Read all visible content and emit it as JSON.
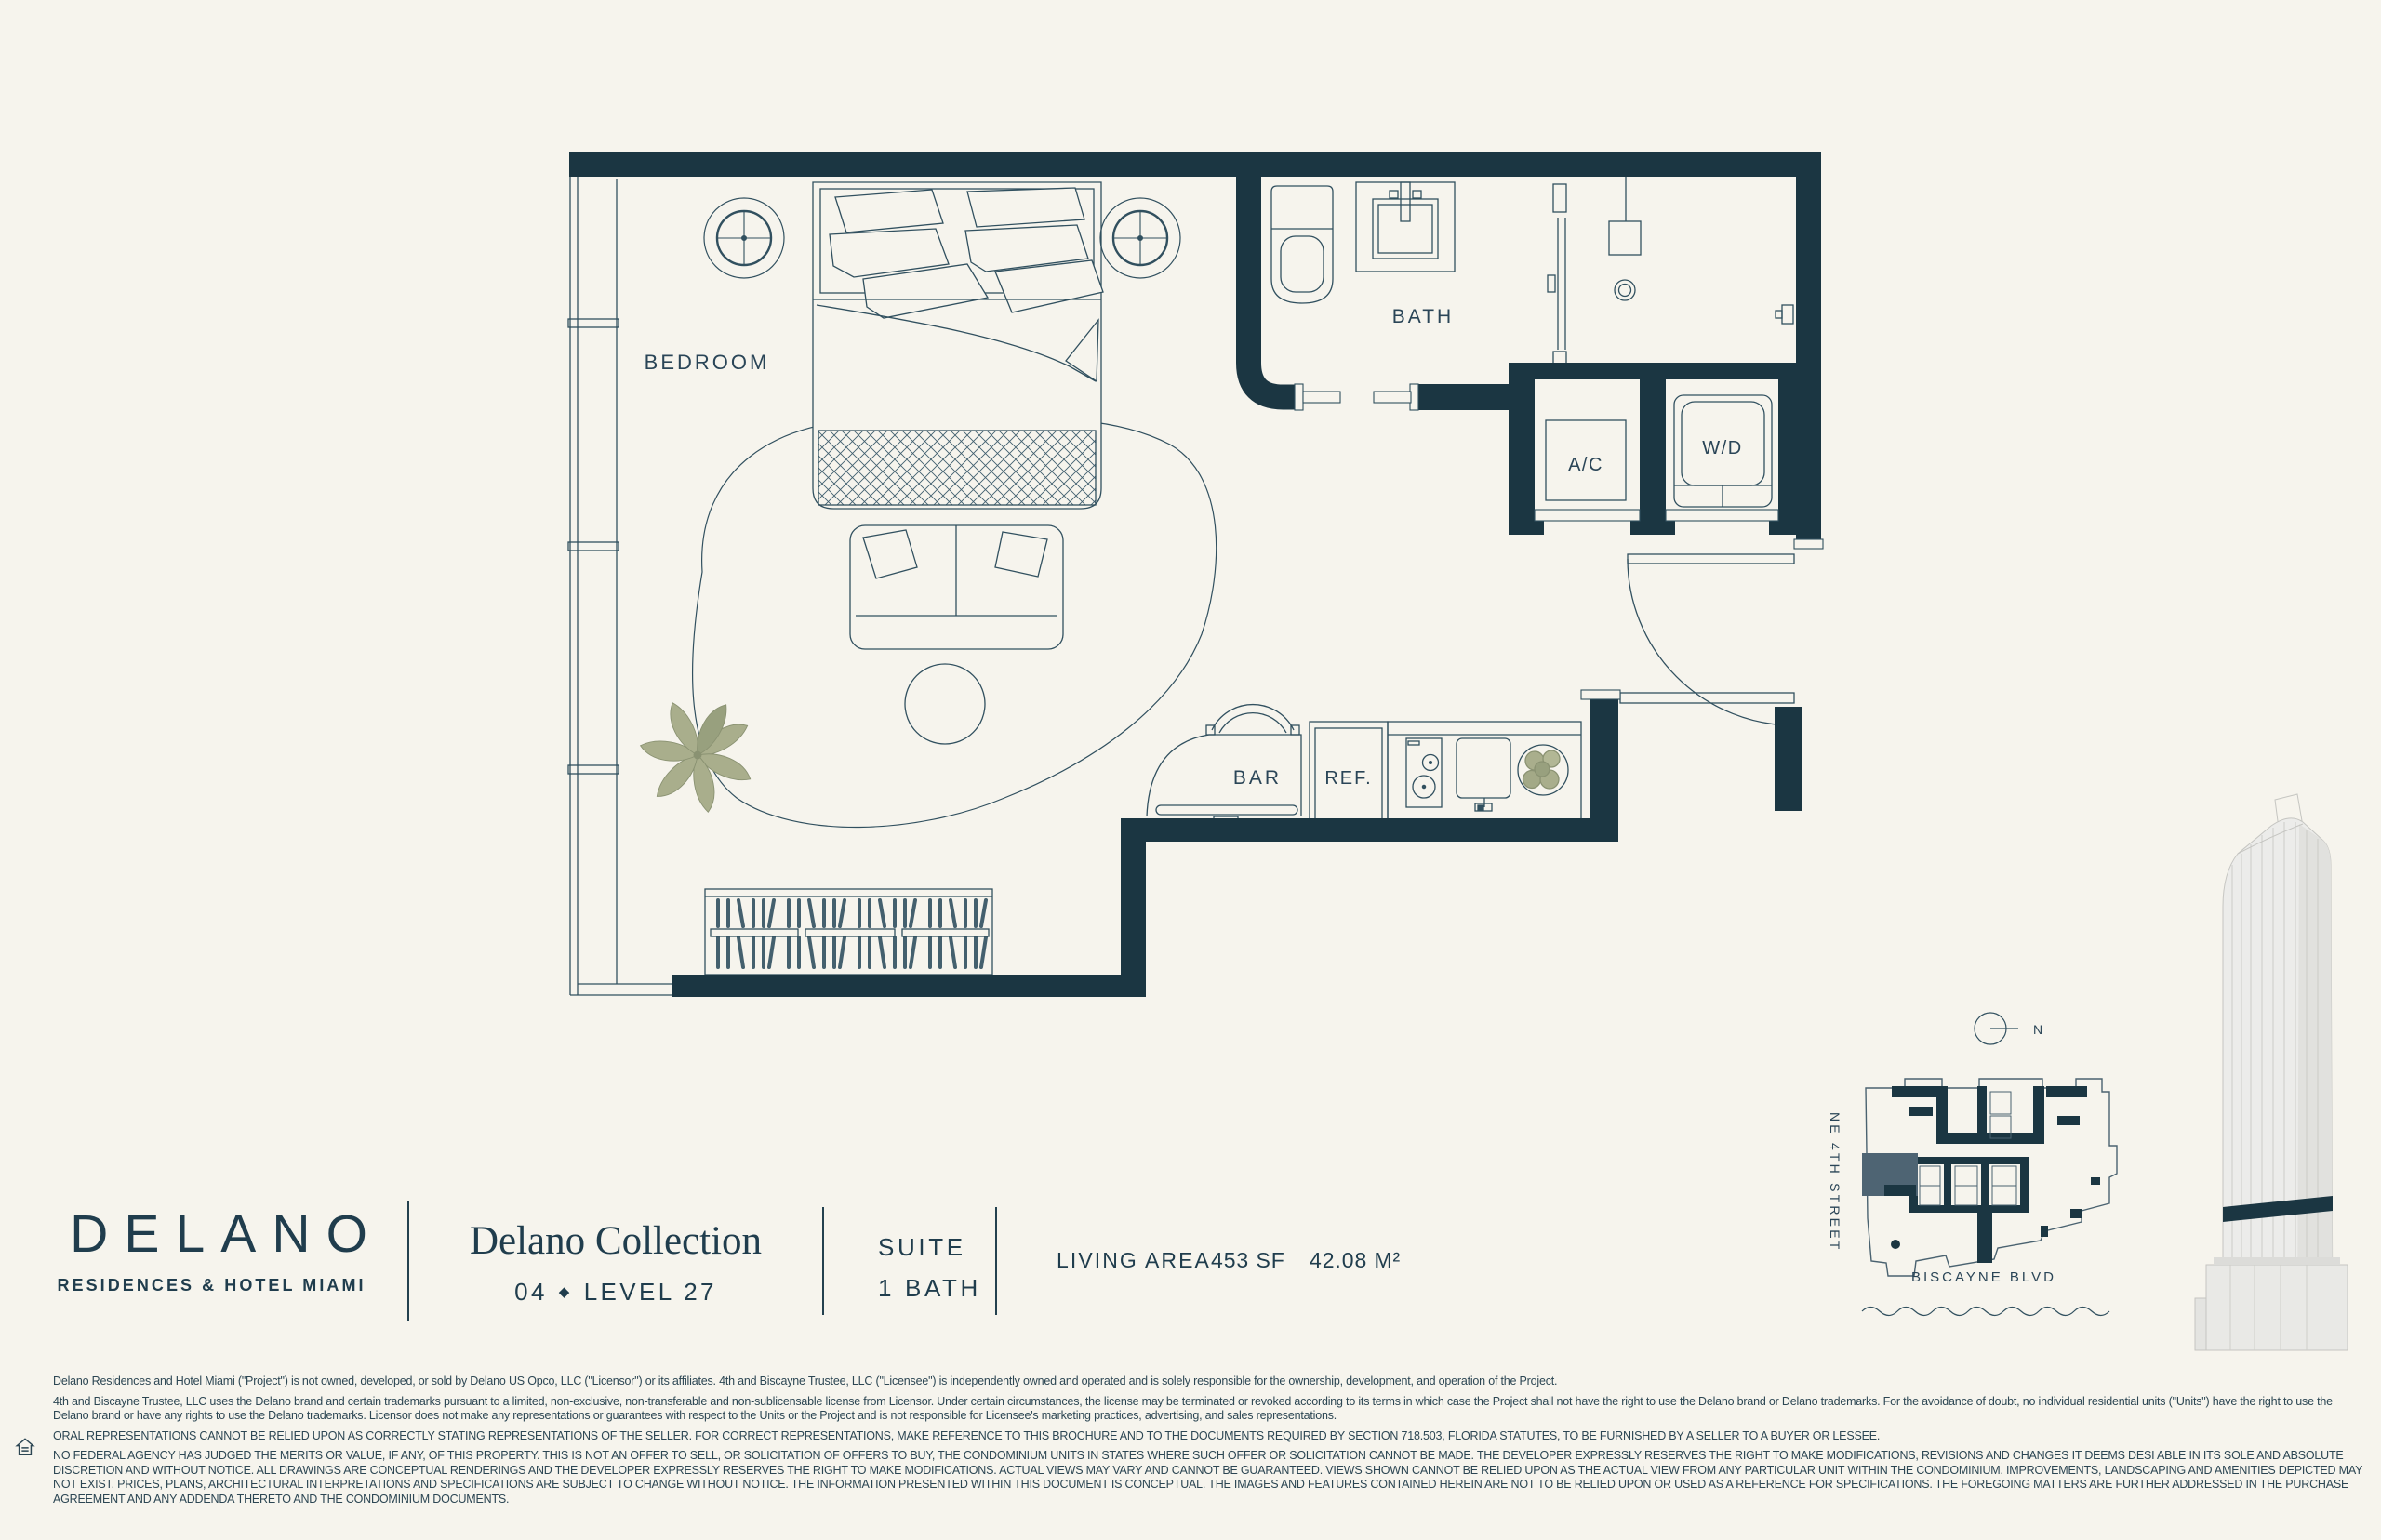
{
  "page": {
    "background_color": "#f6f4ed",
    "wall_color": "#1b3642",
    "line_color": "#31505f",
    "highlight_color": "#4e6473",
    "plant_green": "#a9ae8c"
  },
  "branding": {
    "logo": "DELANO",
    "tagline": "RESIDENCES & HOTEL MIAMI"
  },
  "plan_info": {
    "collection": "Delano Collection",
    "unit_number": "04",
    "separator": "◆",
    "level": "LEVEL 27",
    "suite": "SUITE",
    "baths": "1 BATH",
    "living_area_label": "LIVING AREA",
    "area_sf": "453 SF",
    "area_m2": "42.08 M²"
  },
  "floorplan": {
    "labels": {
      "bedroom": "BEDROOM",
      "bath": "BATH",
      "ac": "A/C",
      "wd": "W/D",
      "bar": "BAR",
      "ref": "REF."
    }
  },
  "keyplan": {
    "north": "N",
    "street": "NE 4TH STREET",
    "boulevard": "BISCAYNE BLVD"
  },
  "legal": {
    "p1": "Delano Residences and Hotel Miami (\"Project\") is not owned, developed, or sold by Delano US Opco, LLC (\"Licensor\") or its affiliates. 4th and Biscayne Trustee, LLC (\"Licensee\") is independently owned and operated and is solely responsible for the ownership, development, and operation of the Project.",
    "p2": "4th and Biscayne Trustee, LLC uses the Delano brand and certain trademarks pursuant to a limited, non-exclusive, non-transferable and non-sublicensable license from Licensor. Under certain circumstances, the license may be terminated or revoked according to its terms in which case the Project shall not have the right to use the Delano brand or Delano trademarks. For the avoidance of doubt, no individual residential units (\"Units\") have the right to use the Delano brand or have any rights to use the Delano trademarks. Licensor does not make any representations or guarantees with respect to the Units or the Project and is not responsible for Licensee's marketing practices, advertising, and sales representations.",
    "p3": "ORAL REPRESENTATIONS CANNOT BE RELIED UPON AS CORRECTLY STATING REPRESENTATIONS OF THE SELLER. FOR CORRECT REPRESENTATIONS, MAKE REFERENCE TO THIS BROCHURE AND TO THE DOCUMENTS REQUIRED BY SECTION 718.503, FLORIDA STATUTES, TO BE FURNISHED BY A SELLER TO A BUYER OR LESSEE.",
    "p4": "NO FEDERAL AGENCY HAS JUDGED THE MERITS OR VALUE, IF ANY, OF THIS PROPERTY. THIS IS NOT AN OFFER TO SELL, OR SOLICITATION OF OFFERS TO BUY, THE CONDOMINIUM UNITS IN STATES WHERE SUCH OFFER OR SOLICITATION CANNOT BE MADE. THE DEVELOPER EXPRESSLY RESERVES THE RIGHT TO MAKE MODIFICATIONS, REVISIONS AND CHANGES IT DEEMS DESI ABLE IN ITS SOLE AND ABSOLUTE DISCRETION AND WITHOUT NOTICE. ALL DRAWINGS ARE CONCEPTUAL RENDERINGS AND THE DEVELOPER EXPRESSLY RESERVES THE RIGHT TO MAKE MODIFICATIONS. ACTUAL VIEWS MAY VARY AND CANNOT BE GUARANTEED. VIEWS SHOWN CANNOT BE RELIED UPON AS THE ACTUAL VIEW FROM ANY PARTICULAR UNIT WITHIN THE CONDOMINIUM. IMPROVEMENTS, LANDSCAPING AND AMENITIES DEPICTED MAY NOT EXIST. PRICES, PLANS, ARCHITECTURAL INTERPRETATIONS AND SPECIFICATIONS ARE SUBJECT TO CHANGE WITHOUT NOTICE. THE INFORMATION PRESENTED WITHIN THIS DOCUMENT IS CONCEPTUAL. THE IMAGES AND FEATURES CONTAINED HEREIN ARE NOT TO BE RELIED UPON OR USED AS A REFERENCE FOR SPECIFICATIONS. THE FOREGOING MATTERS ARE FURTHER ADDRESSED IN THE PURCHASE AGREEMENT AND ANY ADDENDA THERETO AND THE CONDOMINIUM DOCUMENTS."
  }
}
